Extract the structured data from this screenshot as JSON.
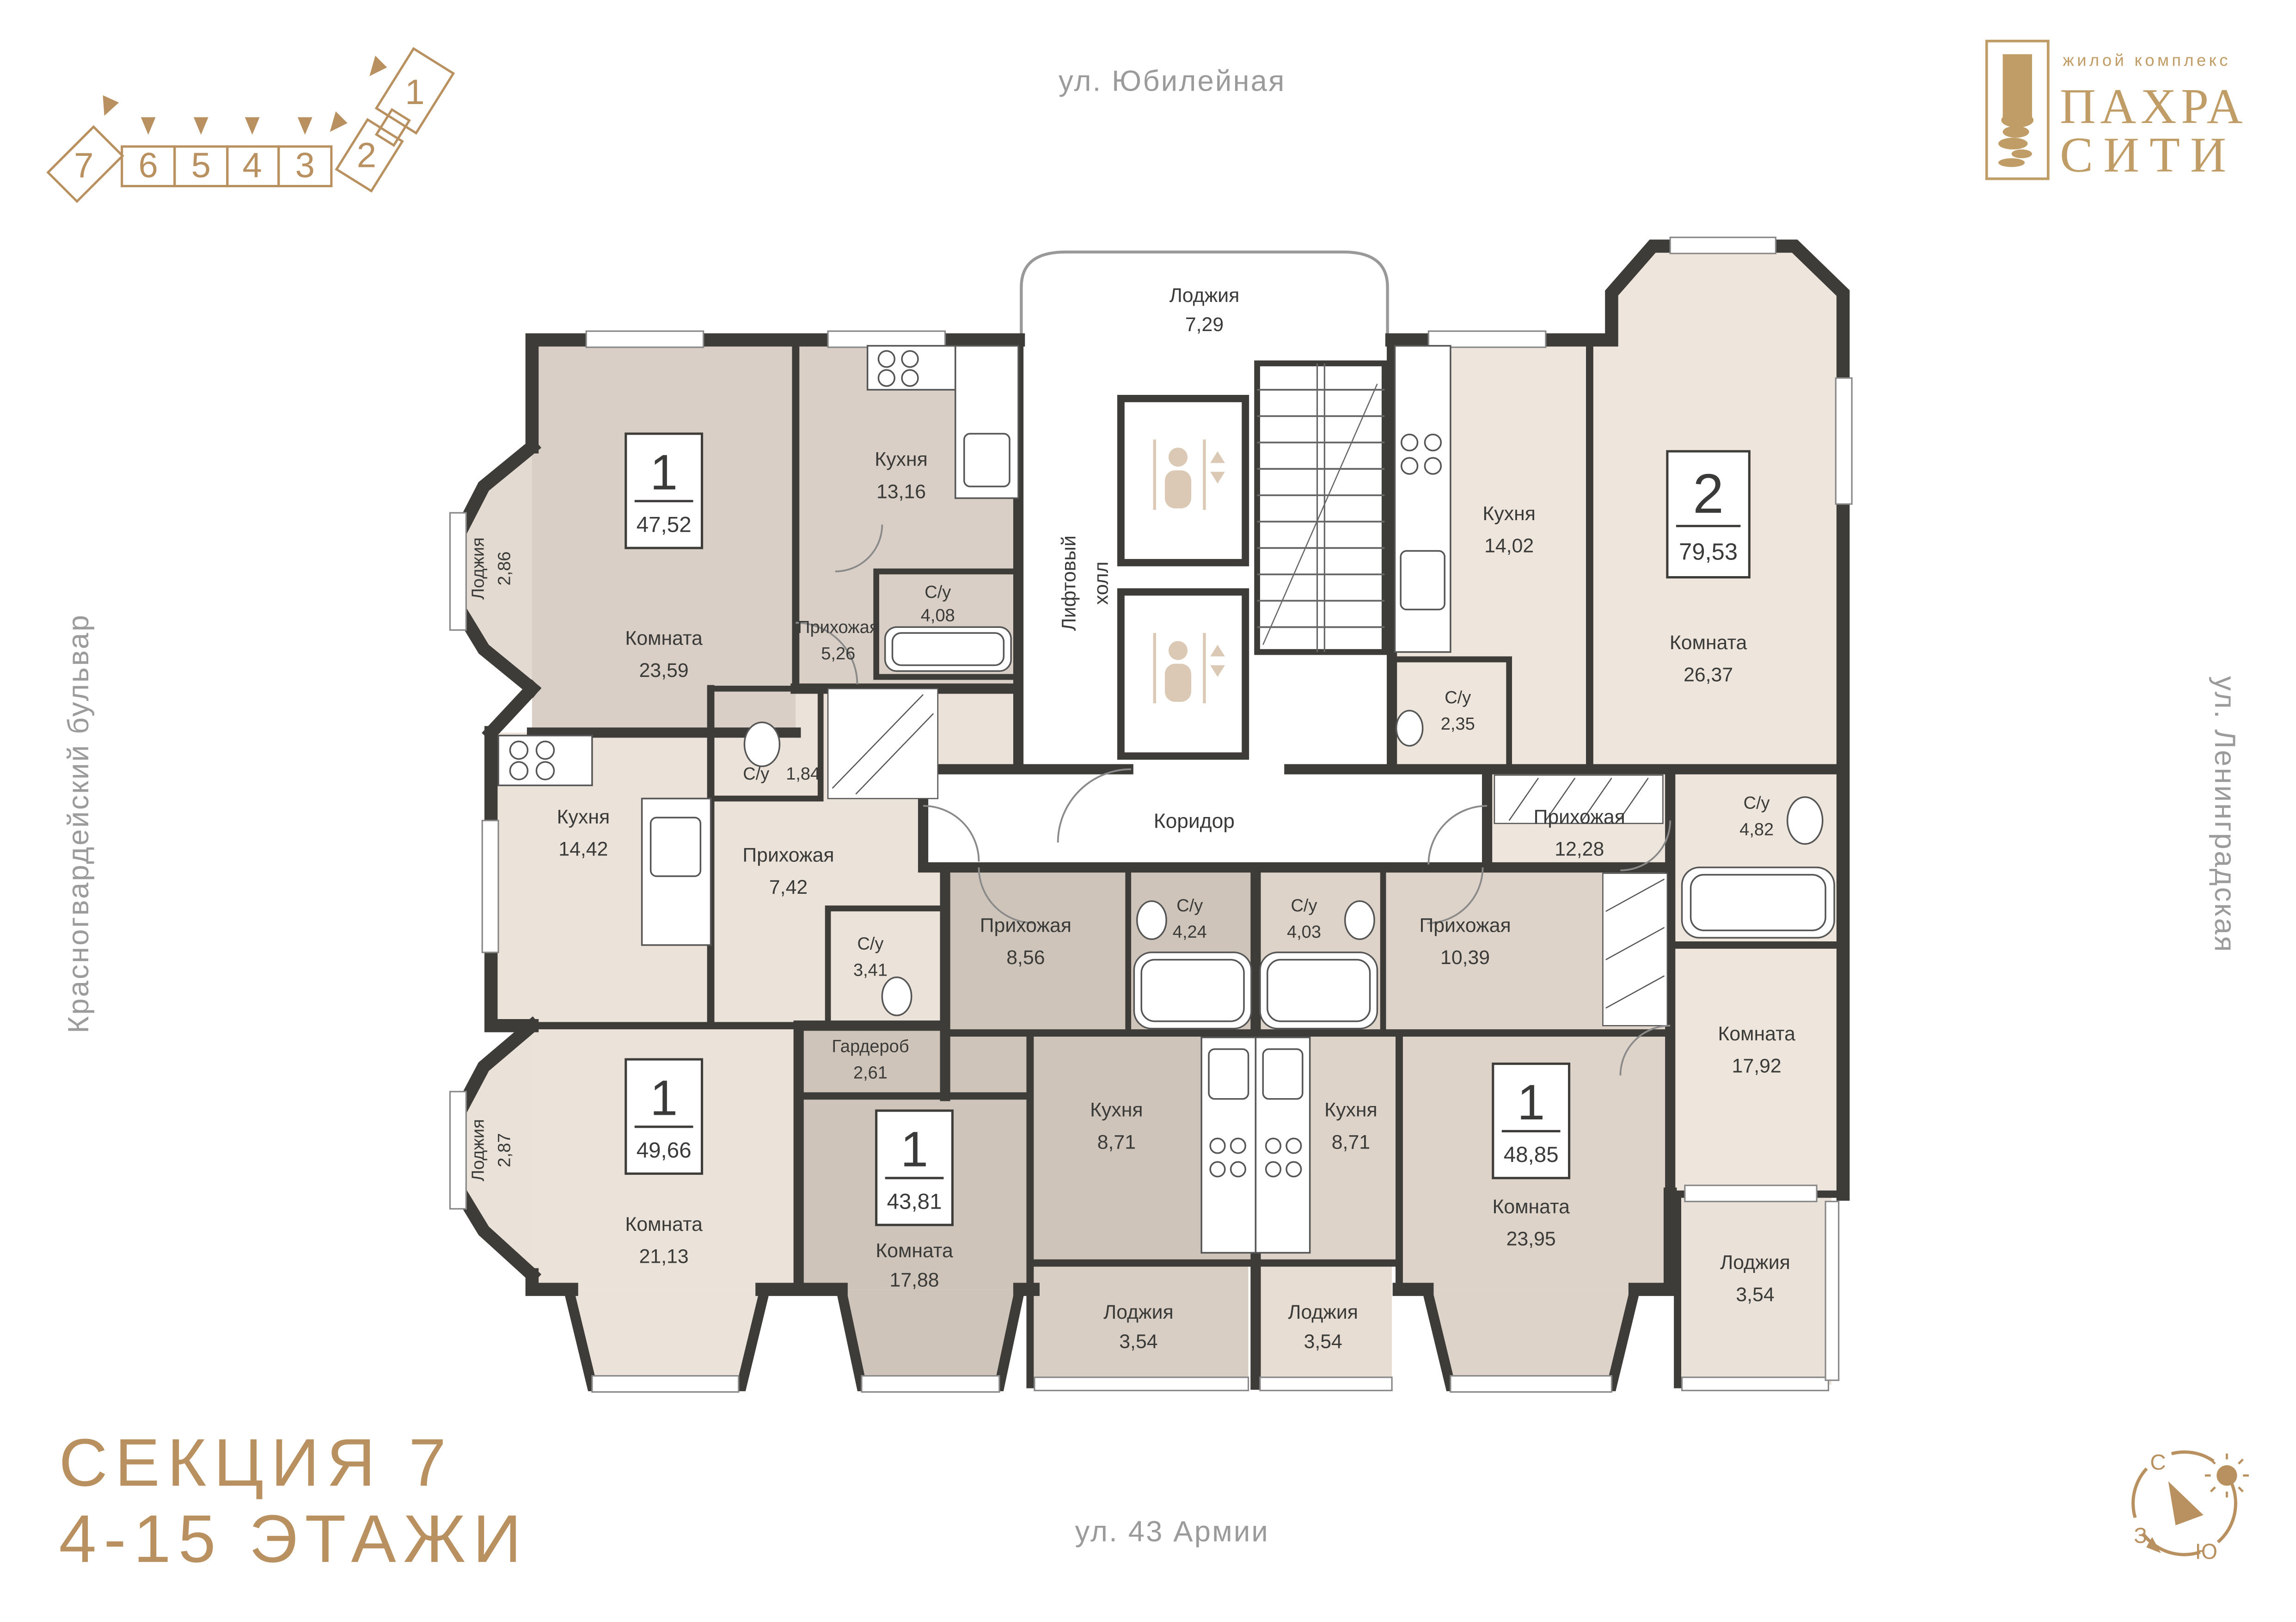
{
  "streets": {
    "top": "ул. Юбилейная",
    "left": "Красногвардейский бульвар",
    "right": "ул. Ленинградская",
    "bottom": "ул. 43 Армии"
  },
  "branding": {
    "tagline": "жилой комплекс",
    "name_line1": "ПАХРА",
    "name_line2": "СИТИ",
    "accent_color": "#c09c66"
  },
  "section_info": {
    "line1": "СЕКЦИЯ 7",
    "line2": "4-15 ЭТАЖИ",
    "accent_color": "#b9905f"
  },
  "section_diagram": {
    "numbers": [
      "7",
      "6",
      "5",
      "4",
      "3",
      "2",
      "1"
    ]
  },
  "compass": {
    "north": "С",
    "west": "З",
    "south": "Ю"
  },
  "core": {
    "loggia": {
      "n": "Лоджия",
      "a": "7,29"
    },
    "lift_line1": "Лифтовый",
    "lift_line2": "холл",
    "corridor": "Коридор"
  },
  "apartments": [
    {
      "type": "1",
      "area": "47,52",
      "rooms": [
        {
          "n": "Комната",
          "a": "23,59"
        },
        {
          "n": "Кухня",
          "a": "13,16"
        },
        {
          "n": "Прихожая",
          "a": "5,26"
        },
        {
          "n": "С/у",
          "a": "4,08"
        },
        {
          "n": "Лоджия",
          "a": "2,86"
        }
      ]
    },
    {
      "type": "2",
      "area": "79,53",
      "rooms": [
        {
          "n": "Кухня",
          "a": "14,02"
        },
        {
          "n": "Комната",
          "a": "26,37"
        },
        {
          "n": "С/у",
          "a": "2,35"
        },
        {
          "n": "Прихожая",
          "a": "12,28"
        },
        {
          "n": "С/у",
          "a": "4,82"
        },
        {
          "n": "Комната",
          "a": "17,92"
        },
        {
          "n": "Лоджия",
          "a": "3,54"
        }
      ]
    },
    {
      "type": "1",
      "area": "49,66",
      "rooms": [
        {
          "n": "Кухня",
          "a": "14,42"
        },
        {
          "n": "С/у",
          "a": "1,84"
        },
        {
          "n": "Прихожая",
          "a": "7,42"
        },
        {
          "n": "С/у",
          "a": "3,41"
        },
        {
          "n": "Комната",
          "a": "21,13"
        },
        {
          "n": "Лоджия",
          "a": "2,87"
        }
      ]
    },
    {
      "type": "1",
      "area": "43,81",
      "rooms": [
        {
          "n": "Прихожая",
          "a": "8,56"
        },
        {
          "n": "С/у",
          "a": "4,24"
        },
        {
          "n": "Гардероб",
          "a": "2,61"
        },
        {
          "n": "Кухня",
          "a": "8,71"
        },
        {
          "n": "Комната",
          "a": "17,88"
        },
        {
          "n": "Лоджия",
          "a": "3,54"
        }
      ]
    },
    {
      "type": "1",
      "area": "48,85",
      "rooms": [
        {
          "n": "Прихожая",
          "a": "10,39"
        },
        {
          "n": "С/у",
          "a": "4,03"
        },
        {
          "n": "Кухня",
          "a": "8,71"
        },
        {
          "n": "Комната",
          "a": "23,95"
        },
        {
          "n": "Лоджия",
          "a": "3,54"
        }
      ]
    }
  ]
}
